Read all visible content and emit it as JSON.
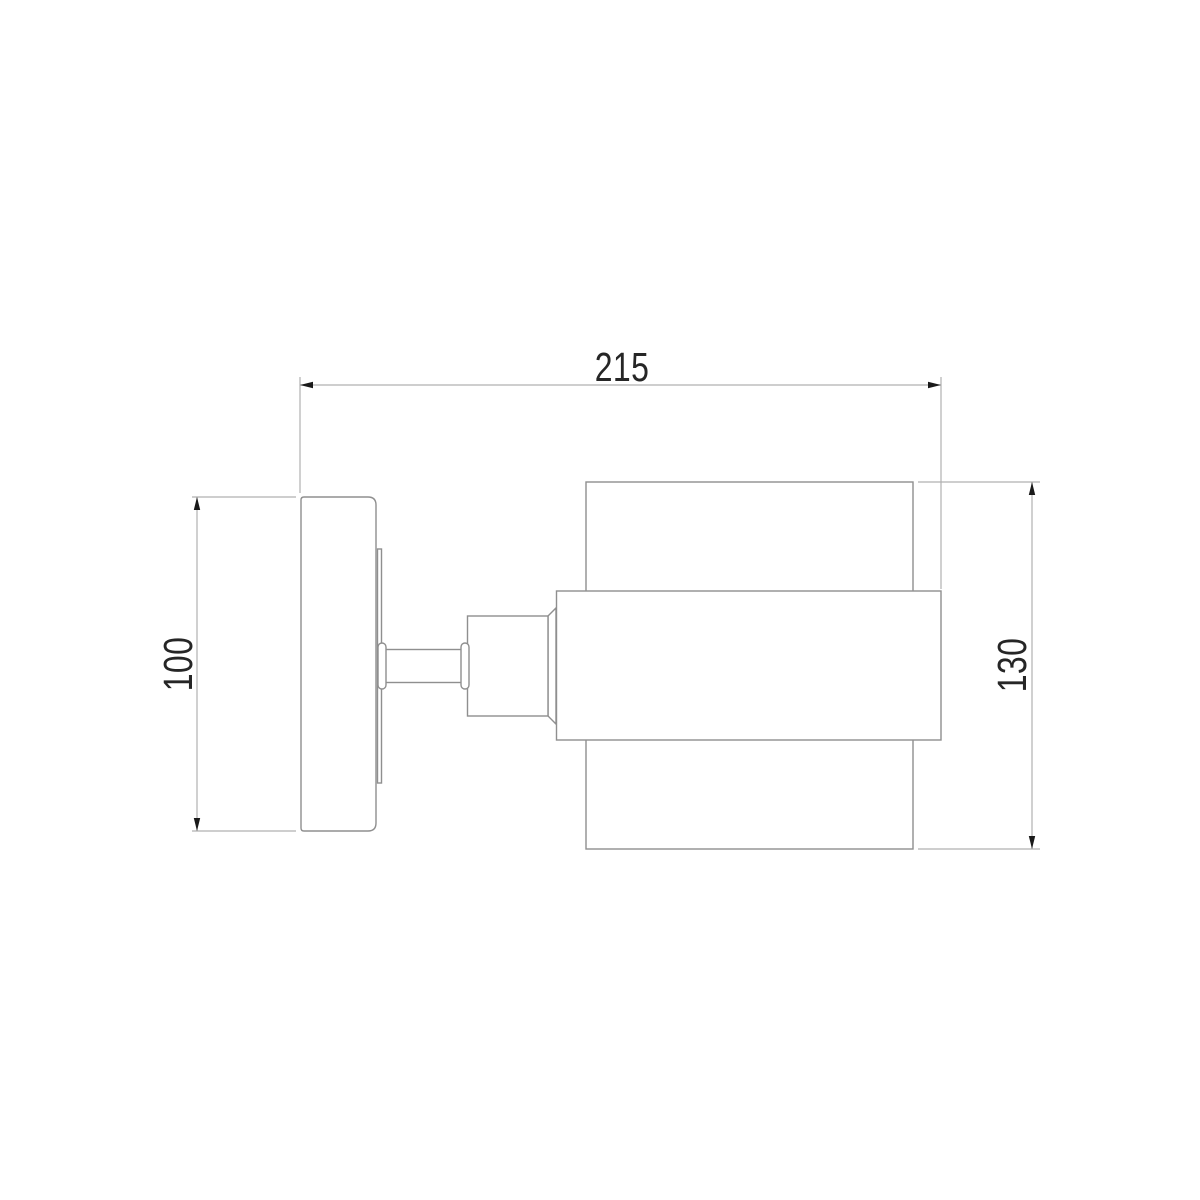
{
  "drawing": {
    "kind": "dimensioned-side-view",
    "subject": "wall-sconce-lamp",
    "labels": {
      "width": "215",
      "plate_height": "100",
      "shade_height": "130"
    },
    "colors": {
      "background": "#ffffff",
      "outline": "#8f8f8f",
      "dimension_line": "#b0b0b0",
      "arrow": "#1a1a1a",
      "label_text": "#262626"
    },
    "parts": [
      "wall-plate",
      "mount-strip",
      "pivot-capsule-left",
      "arm-bar",
      "pivot-capsule-right",
      "joint-block",
      "socket-cone",
      "shade-front-band",
      "shade-cylinder"
    ]
  }
}
